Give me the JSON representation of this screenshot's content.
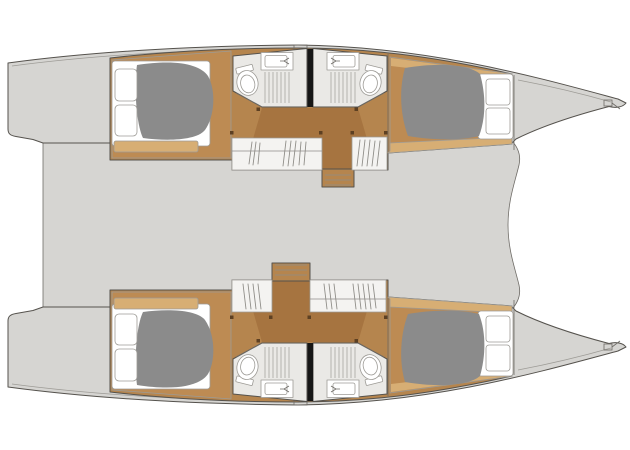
{
  "meta": {
    "title": "Catamaran interior deck plan",
    "view": "top-down layout drawing, bows facing right, no text labels",
    "canvas": {
      "width": 630,
      "height": 450
    }
  },
  "colors": {
    "background": "#ffffff",
    "deck": "#d6d5d2",
    "outline": "#55524d",
    "wood": "#b5854e",
    "wood_walkway": "#a67440",
    "wood_cabin": "#bd8b53",
    "wood_light": "#d7ae74",
    "mattress": "#8b8b8b",
    "linen": "#ffffff",
    "bathroom_floor": "#eae9e6",
    "fixture": "#ffffff",
    "wardrobe": "#f4f3f1",
    "divider": "#161616",
    "post": "#5d4022",
    "hatch": "#e8e7e4"
  },
  "legend": {
    "hulls": [
      {
        "id": "upper-hull",
        "position": "top"
      },
      {
        "id": "lower-hull",
        "position": "bottom"
      }
    ],
    "compartments_per_hull": [
      "aft double cabin with mattress and pillows",
      "aft bathroom: toilet, sink, shower grate",
      "forward bathroom: toilet, sink, shower grate",
      "forward double cabin with mattress and pillows",
      "hanging wardrobes",
      "companionway steps"
    ],
    "shared_features": [
      "central bridgedeck (undetailed saloon area)",
      "swim platforms at sterns (left)",
      "pointed bows with anchor fitting (right)",
      "deck hatches above bathrooms"
    ]
  }
}
